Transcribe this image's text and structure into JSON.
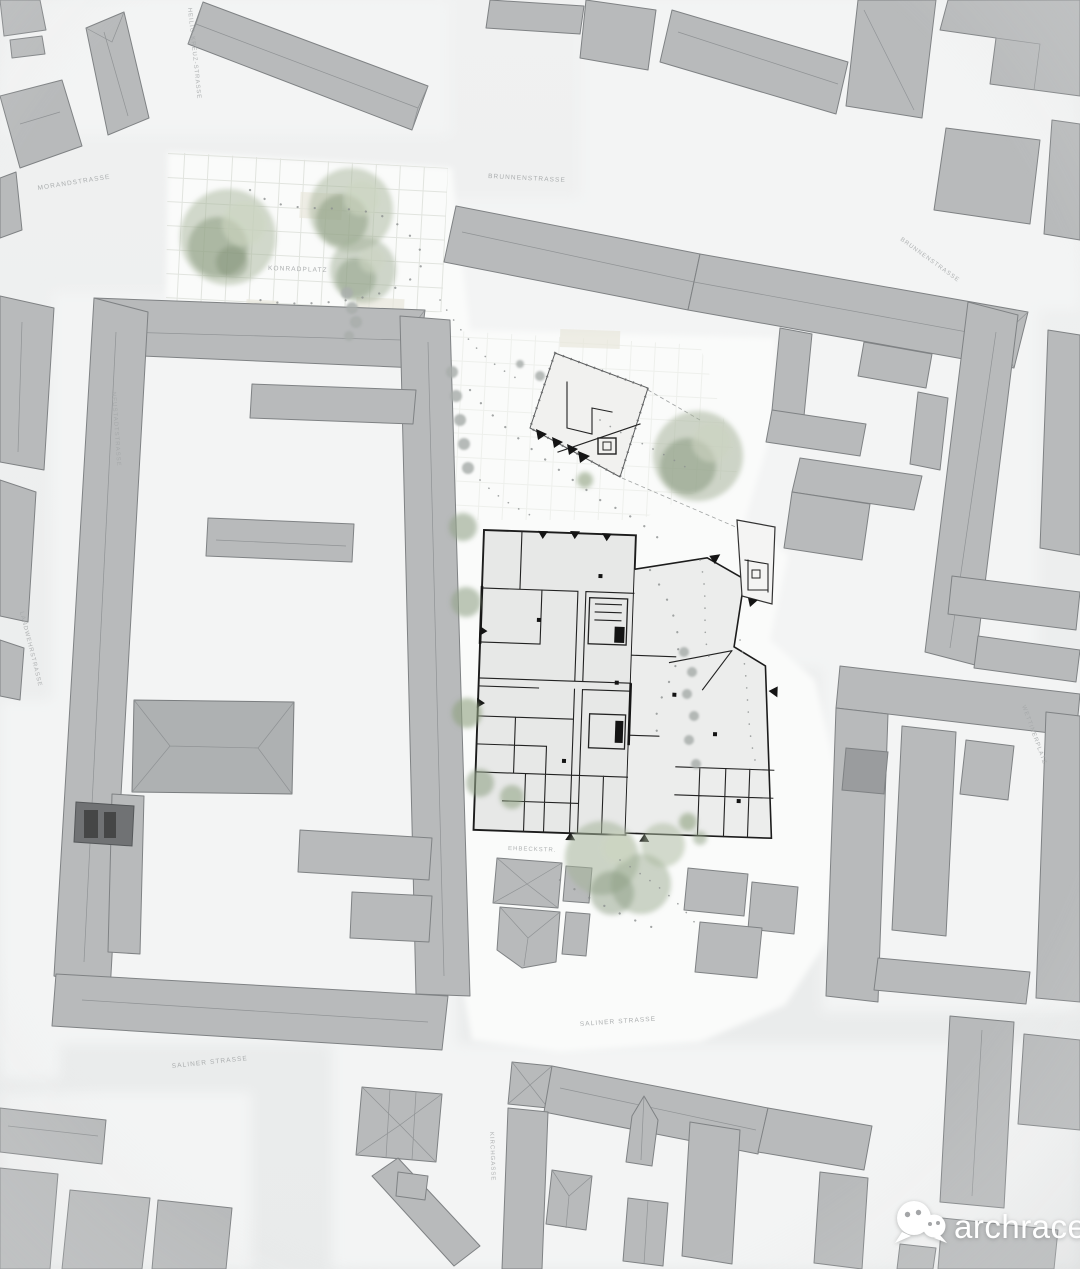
{
  "street_labels": [
    {
      "id": "brunnenstrasse-top",
      "text": "BRUNNENSTRASSE"
    },
    {
      "id": "brunnenstrasse-east",
      "text": "BRUNNENSTRASSE"
    },
    {
      "id": "morandstrasse",
      "text": "MORANDSTRASSE"
    },
    {
      "id": "heiligkreuz-strasse",
      "text": "HEILIG-KREUZ-STRASSE"
    },
    {
      "id": "neustadtstrasse",
      "text": "NEUSTADTSTRASSE"
    },
    {
      "id": "landwehrstrasse",
      "text": "LANDWEHRSTRASSE"
    },
    {
      "id": "konradplatz",
      "text": "KONRADPLATZ"
    },
    {
      "id": "wettinerplatz",
      "text": "WETTINERPLATZ"
    },
    {
      "id": "ehbeckstrasse",
      "text": "EHBECKSTR."
    },
    {
      "id": "kirchgasse",
      "text": "KIRCHGASSE"
    },
    {
      "id": "saliner-strasse-west",
      "text": "SALINER STRASSE"
    },
    {
      "id": "saliner-strasse-center",
      "text": "SALINER STRASSE"
    }
  ],
  "watermark": {
    "brand": "archrace",
    "icon": "wechat-chat-bubbles-icon"
  },
  "palette": {
    "street": "#eaecec",
    "block_ground": "#f3f4f4",
    "site_white": "#fafbfa",
    "building": "#b8babb",
    "building_outline": "#7f8284",
    "tree_green": "#93a289",
    "plan_wall": "#1e1e1e",
    "label_gray": "#a4a7a8",
    "watermark_white": "#ffffff"
  }
}
